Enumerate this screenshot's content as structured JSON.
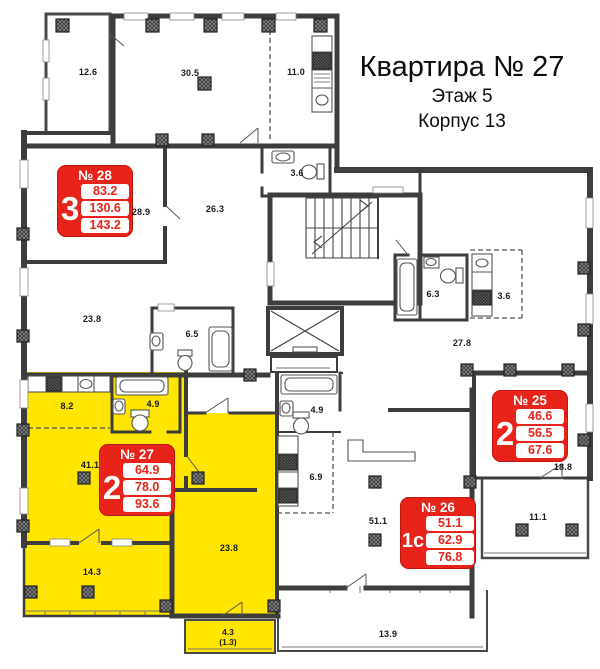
{
  "title": {
    "line1": "Квартира № 27",
    "line2": "Этаж 5",
    "line3": "Корпус 13"
  },
  "apartments": [
    {
      "number": "№ 28",
      "rooms": "3",
      "areas": [
        "83.2",
        "130.6",
        "143.2"
      ]
    },
    {
      "number": "№ 27",
      "rooms": "2",
      "areas": [
        "64.9",
        "78.0",
        "93.6"
      ]
    },
    {
      "number": "№ 25",
      "rooms": "2",
      "areas": [
        "46.6",
        "56.5",
        "67.6"
      ]
    },
    {
      "number": "№ 26",
      "rooms": "1с",
      "areas": [
        "51.1",
        "62.9",
        "76.8"
      ]
    }
  ],
  "room_labels": [
    "12.6",
    "30.5",
    "11.0",
    "28.9",
    "26.3",
    "3.6",
    "23.8",
    "6.5",
    "6.3",
    "3.6",
    "27.8",
    "8.2",
    "4.9",
    "41.1",
    "4.9",
    "6.9",
    "51.1",
    "18.8",
    "11.1",
    "14.3",
    "23.8",
    "13.9"
  ],
  "balcony_label": {
    "area": "4.3",
    "reduced": "(1.3)"
  },
  "colors": {
    "highlight_yellow": "#FFE500",
    "accent_red": "#E8231A",
    "wall": "#3D3D3D"
  }
}
